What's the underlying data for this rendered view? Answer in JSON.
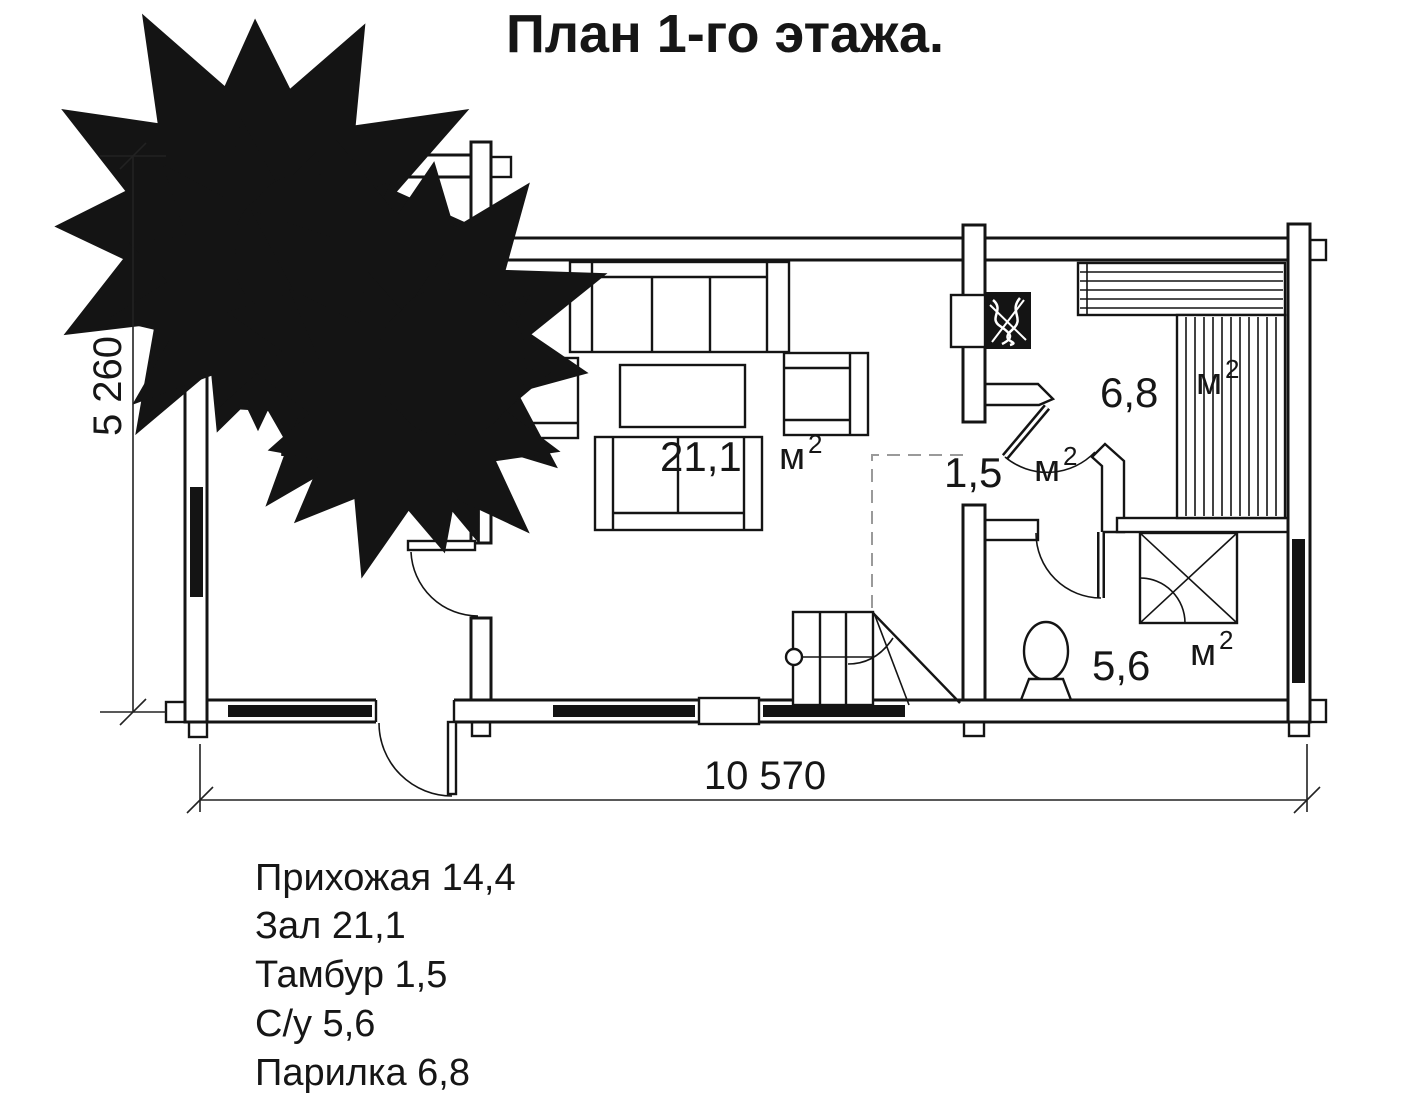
{
  "title": "План 1-го этажа.",
  "dimensions": {
    "width": "10 570",
    "height": "5 260"
  },
  "rooms": {
    "hallway": {
      "area": "14,4",
      "unit": "м",
      "sup": ""
    },
    "hall": {
      "area": "21,1",
      "unit": "м",
      "sup": "2"
    },
    "tambour": {
      "area": "1,5",
      "unit": "м",
      "sup": "2"
    },
    "steam": {
      "area": "6,8",
      "unit": "м",
      "sup": "2"
    },
    "bath": {
      "area": "5,6",
      "unit": "м",
      "sup": "2"
    }
  },
  "legend": [
    "Прихожая 14,4",
    "Зал 21,1",
    "Тамбур 1,5",
    "С/у 5,6",
    "Парилка 6,8"
  ],
  "colors": {
    "line": "#141414",
    "background": "#ffffff",
    "dashed": "#9a9a9a"
  }
}
